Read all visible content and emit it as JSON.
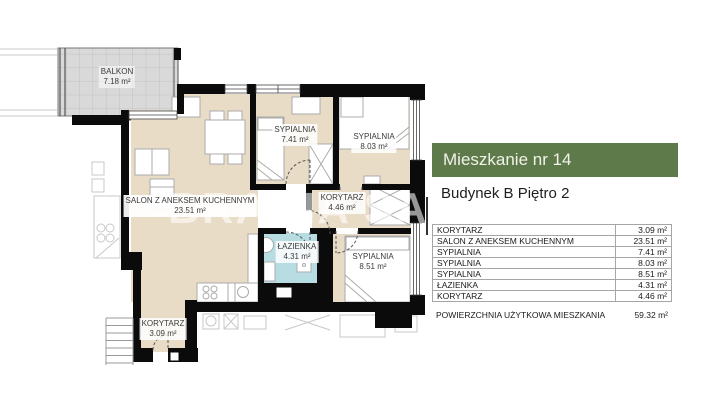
{
  "title_panel": {
    "apartment_title": "Mieszkanie nr 14",
    "building_subtitle": "Budynek B Piętro 2",
    "banner_color": "#5e7a4a"
  },
  "floor_plan": {
    "watermark": "BRACIA SADURSCY",
    "colors": {
      "room_fill": "#e9dcc6",
      "bathroom_fill": "#b7dde2",
      "balcony_fill": "#d9d9d9",
      "wall": "#0b0b0b"
    },
    "rooms": [
      {
        "name": "BALKON",
        "area": "7.18 m²"
      },
      {
        "name": "SYPIALNIA",
        "area": "7.41 m²"
      },
      {
        "name": "SYPIALNIA",
        "area": "8.03 m²"
      },
      {
        "name": "SALON Z ANEKSEM KUCHENNYM",
        "area": "23.51 m²"
      },
      {
        "name": "KORYTARZ",
        "area": "4.46 m²"
      },
      {
        "name": "ŁAZIENKA",
        "area": "4.31 m²"
      },
      {
        "name": "SYPIALNIA",
        "area": "8.51 m²"
      },
      {
        "name": "KORYTARZ",
        "area": "3.09 m²"
      }
    ]
  },
  "area_table": {
    "rows": [
      {
        "name": "KORYTARZ",
        "area": "3.09 m²"
      },
      {
        "name": "SALON Z ANEKSEM KUCHENNYM",
        "area": "23.51 m²"
      },
      {
        "name": "SYPIALNIA",
        "area": "7.41 m²"
      },
      {
        "name": "SYPIALNIA",
        "area": "8.03 m²"
      },
      {
        "name": "SYPIALNIA",
        "area": "8.51 m²"
      },
      {
        "name": "ŁAZIENKA",
        "area": "4.31 m²"
      },
      {
        "name": "KORYTARZ",
        "area": "4.46 m²"
      }
    ],
    "total": {
      "name": "POWIERZCHNIA UŻYTKOWA MIESZKANIA",
      "area": "59.32 m²"
    }
  }
}
